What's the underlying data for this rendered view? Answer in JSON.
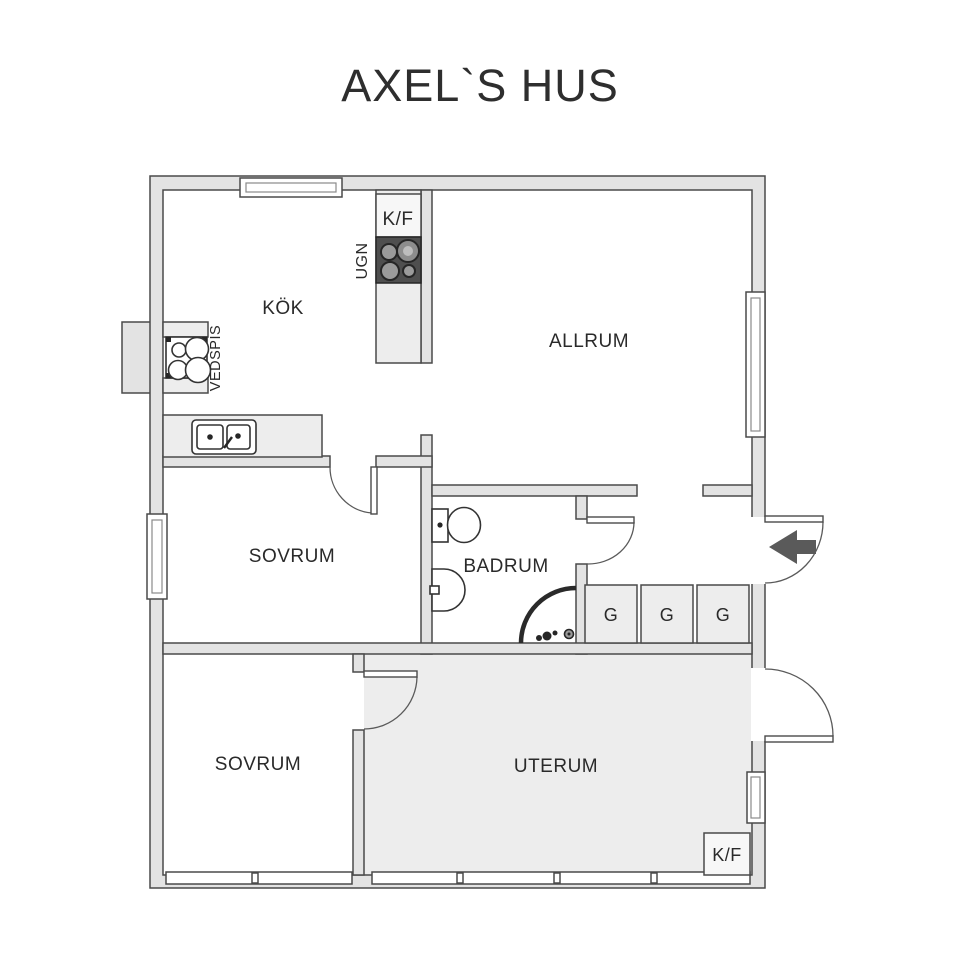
{
  "title": "AXEL`S HUS",
  "rooms": {
    "kitchen": "KÖK",
    "living": "ALLRUM",
    "bedroom1": "SOVRUM",
    "bathroom": "BADRUM",
    "bedroom2": "SOVRUM",
    "sunroom": "UTERUM"
  },
  "appliances": {
    "fridge_freezer_top": "K/F",
    "oven": "UGN",
    "wood_stove": "VEDSPIS",
    "fridge_freezer_sunroom": "K/F"
  },
  "closets": [
    "G",
    "G",
    "G"
  ],
  "colors": {
    "wall_fill": "#e3e3e3",
    "wall_stroke": "#4a4a4a",
    "fixture_dark": "#4f4f4f",
    "floor_shade": "#ededed",
    "text": "#2a2a2a",
    "arrow": "#5a5a5a"
  }
}
